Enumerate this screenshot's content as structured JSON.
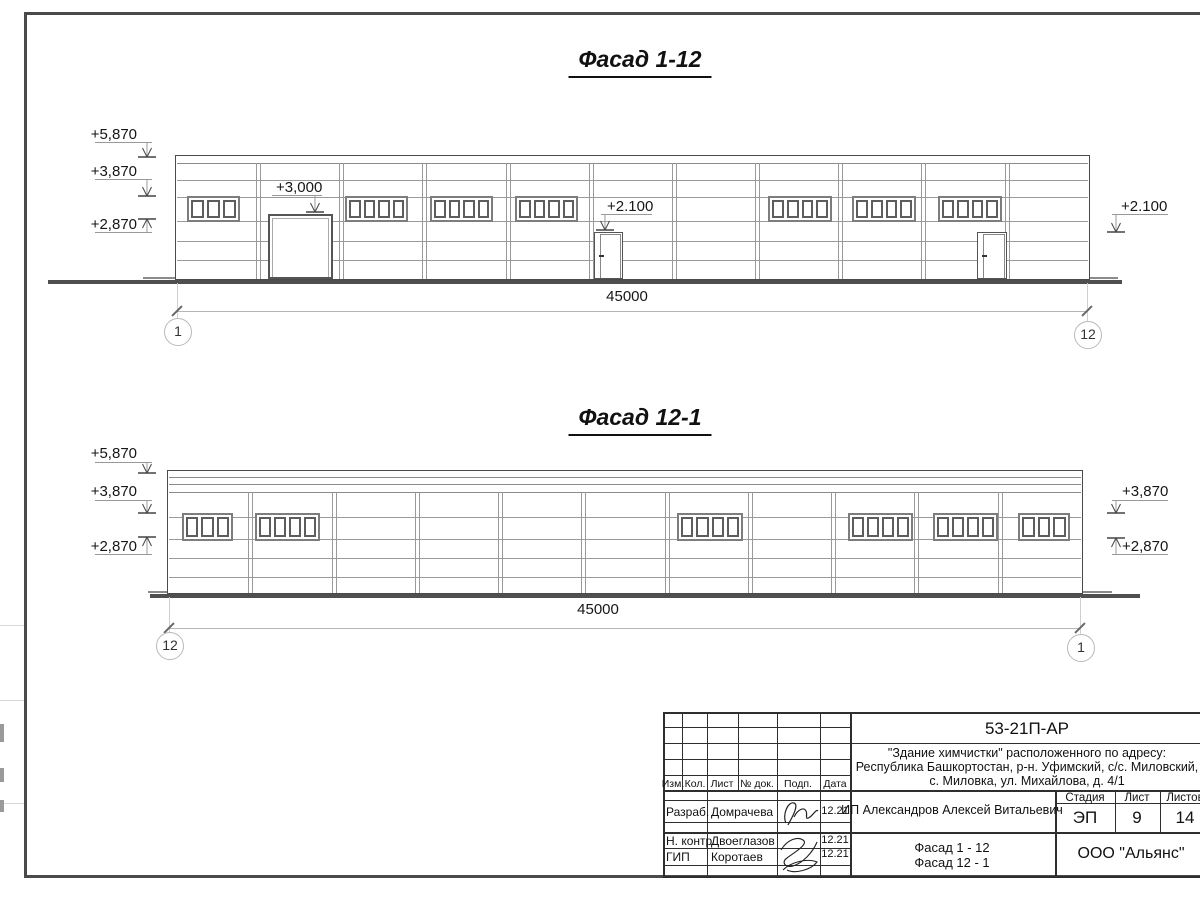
{
  "facades": [
    {
      "title": "Фасад 1-12",
      "dim_label": "45000",
      "title_pos": {
        "x": 640,
        "y": 46
      },
      "geom": {
        "x": 175,
        "w": 915,
        "top": 155,
        "ground": 280,
        "col_top": 163,
        "band": [
          163
        ],
        "hlines": [
          180,
          197,
          221,
          241,
          260
        ],
        "cols": [
          258,
          341,
          424,
          508,
          591,
          674,
          757,
          840,
          923,
          1007
        ],
        "win_y": 196,
        "win_h": 26,
        "windows": [
          {
            "x": 187,
            "w": 53,
            "panes": 3
          },
          {
            "x": 345,
            "w": 63,
            "panes": 4
          },
          {
            "x": 430,
            "w": 63,
            "panes": 4
          },
          {
            "x": 515,
            "w": 63,
            "panes": 4
          },
          {
            "x": 768,
            "w": 64,
            "panes": 4
          },
          {
            "x": 852,
            "w": 64,
            "panes": 4
          },
          {
            "x": 938,
            "w": 64,
            "panes": 4
          }
        ],
        "gate": {
          "x": 268,
          "w": 65,
          "top": 214
        },
        "doors": [
          {
            "x": 594,
            "w": 29,
            "top": 232
          },
          {
            "x": 977,
            "w": 30,
            "top": 232
          }
        ],
        "ground_line": {
          "x1": 48,
          "x2": 1122
        },
        "ramps": [
          {
            "x1": 143,
            "x2": 175
          },
          {
            "x1": 1090,
            "x2": 1118
          }
        ],
        "dim": {
          "y": 311,
          "x1": 177,
          "x2": 1087,
          "label_x": 627,
          "label_y": 288
        }
      },
      "bubbles": [
        {
          "label": "1",
          "x": 177,
          "y": 331
        },
        {
          "label": "12",
          "x": 1087,
          "y": 334
        }
      ],
      "marks": [
        {
          "label": "+5,870",
          "tx": 137,
          "ty": 126,
          "align": "right",
          "shelf": [
            95,
            152,
            142
          ],
          "arrow": [
            147,
            142,
            157,
            "down"
          ]
        },
        {
          "label": "+3,870",
          "tx": 137,
          "ty": 163,
          "align": "right",
          "shelf": [
            95,
            152,
            179
          ],
          "arrow": [
            147,
            179,
            196,
            "down"
          ]
        },
        {
          "label": "+2,870",
          "tx": 137,
          "ty": 216,
          "align": "right",
          "shelf": [
            95,
            152,
            232
          ],
          "arrow": [
            147,
            232,
            219,
            "up"
          ]
        },
        {
          "label": "+2.100",
          "tx": 1121,
          "ty": 198,
          "align": "left",
          "shelf": [
            1112,
            1168,
            214
          ],
          "arrow": [
            1116,
            214,
            232,
            "down"
          ]
        },
        {
          "label": "+3,000",
          "tx": 276,
          "ty": 179,
          "align": "left",
          "shelf": [
            272,
            322,
            195
          ],
          "arrow": [
            315,
            195,
            212,
            "down"
          ]
        },
        {
          "label": "+2.100",
          "tx": 607,
          "ty": 198,
          "align": "left",
          "shelf": [
            601,
            652,
            214
          ],
          "arrow": [
            605,
            214,
            230,
            "down"
          ]
        }
      ]
    },
    {
      "title": "Фасад 12-1",
      "dim_label": "45000",
      "title_pos": {
        "x": 640,
        "y": 404
      },
      "geom": {
        "x": 167,
        "w": 916,
        "top": 470,
        "ground": 594,
        "col_top": 492,
        "band": [
          477,
          484,
          492
        ],
        "hlines": [
          517,
          539,
          558,
          577
        ],
        "cols": [
          250,
          334,
          417,
          500,
          583,
          667,
          750,
          833,
          916,
          1000
        ],
        "win_y": 513,
        "win_h": 28,
        "windows": [
          {
            "x": 182,
            "w": 51,
            "panes": 3
          },
          {
            "x": 255,
            "w": 65,
            "panes": 4
          },
          {
            "x": 677,
            "w": 66,
            "panes": 4
          },
          {
            "x": 848,
            "w": 65,
            "panes": 4
          },
          {
            "x": 933,
            "w": 65,
            "panes": 4
          },
          {
            "x": 1018,
            "w": 52,
            "panes": 3
          }
        ],
        "gate": null,
        "doors": [],
        "ground_line": {
          "x1": 150,
          "x2": 1140
        },
        "ramps": [
          {
            "x1": 148,
            "x2": 167
          },
          {
            "x1": 1083,
            "x2": 1112
          }
        ],
        "dim": {
          "y": 628,
          "x1": 169,
          "x2": 1080,
          "label_x": 598,
          "label_y": 601
        }
      },
      "bubbles": [
        {
          "label": "12",
          "x": 169,
          "y": 645
        },
        {
          "label": "1",
          "x": 1080,
          "y": 647
        }
      ],
      "marks": [
        {
          "label": "+5,870",
          "tx": 137,
          "ty": 445,
          "align": "right",
          "shelf": [
            95,
            152,
            462
          ],
          "arrow": [
            147,
            462,
            473,
            "down"
          ]
        },
        {
          "label": "+3,870",
          "tx": 137,
          "ty": 483,
          "align": "right",
          "shelf": [
            95,
            152,
            500
          ],
          "arrow": [
            147,
            500,
            513,
            "down"
          ]
        },
        {
          "label": "+2,870",
          "tx": 137,
          "ty": 538,
          "align": "right",
          "shelf": [
            95,
            152,
            554
          ],
          "arrow": [
            147,
            554,
            537,
            "up"
          ]
        },
        {
          "label": "+3,870",
          "tx": 1122,
          "ty": 483,
          "align": "left",
          "shelf": [
            1112,
            1168,
            500
          ],
          "arrow": [
            1116,
            500,
            513,
            "down"
          ]
        },
        {
          "label": "+2,870",
          "tx": 1122,
          "ty": 538,
          "align": "left",
          "shelf": [
            1112,
            1168,
            554
          ],
          "arrow": [
            1116,
            554,
            538,
            "up"
          ]
        }
      ]
    }
  ],
  "titleblock": {
    "doc_code": "53-21П-АР",
    "project_lines": [
      "\"Здание химчистки\" расположенного по адресу:",
      "Республика Башкортостан, р-н. Уфимский, с/с. Миловский,",
      "с. Миловка, ул. Михайлова, д. 4/1"
    ],
    "header": {
      "izm": "Изм.",
      "kol": "Кол.",
      "list": "Лист",
      "doc": "№ док.",
      "podp": "Подп.",
      "data": "Дата"
    },
    "rows": [
      {
        "role": "Разраб.",
        "name": "Домрачева",
        "date": "12.21"
      },
      {
        "role": "Н. контр.",
        "name": "Двоеглазов",
        "date": "12.21"
      },
      {
        "role": "ГИП",
        "name": "Коротаев",
        "date": "12.21"
      }
    ],
    "client": "ИП Александров Алексей Витальевич",
    "stage_label": "Стадия",
    "sheet_label": "Лист",
    "sheets_label": "Листов",
    "stage": "ЭП",
    "sheet_no": "9",
    "sheets_total": "14",
    "sheet_title_lines": [
      "Фасад 1 - 12",
      "Фасад 12 - 1"
    ],
    "org": "ООО \"Альянс\""
  }
}
